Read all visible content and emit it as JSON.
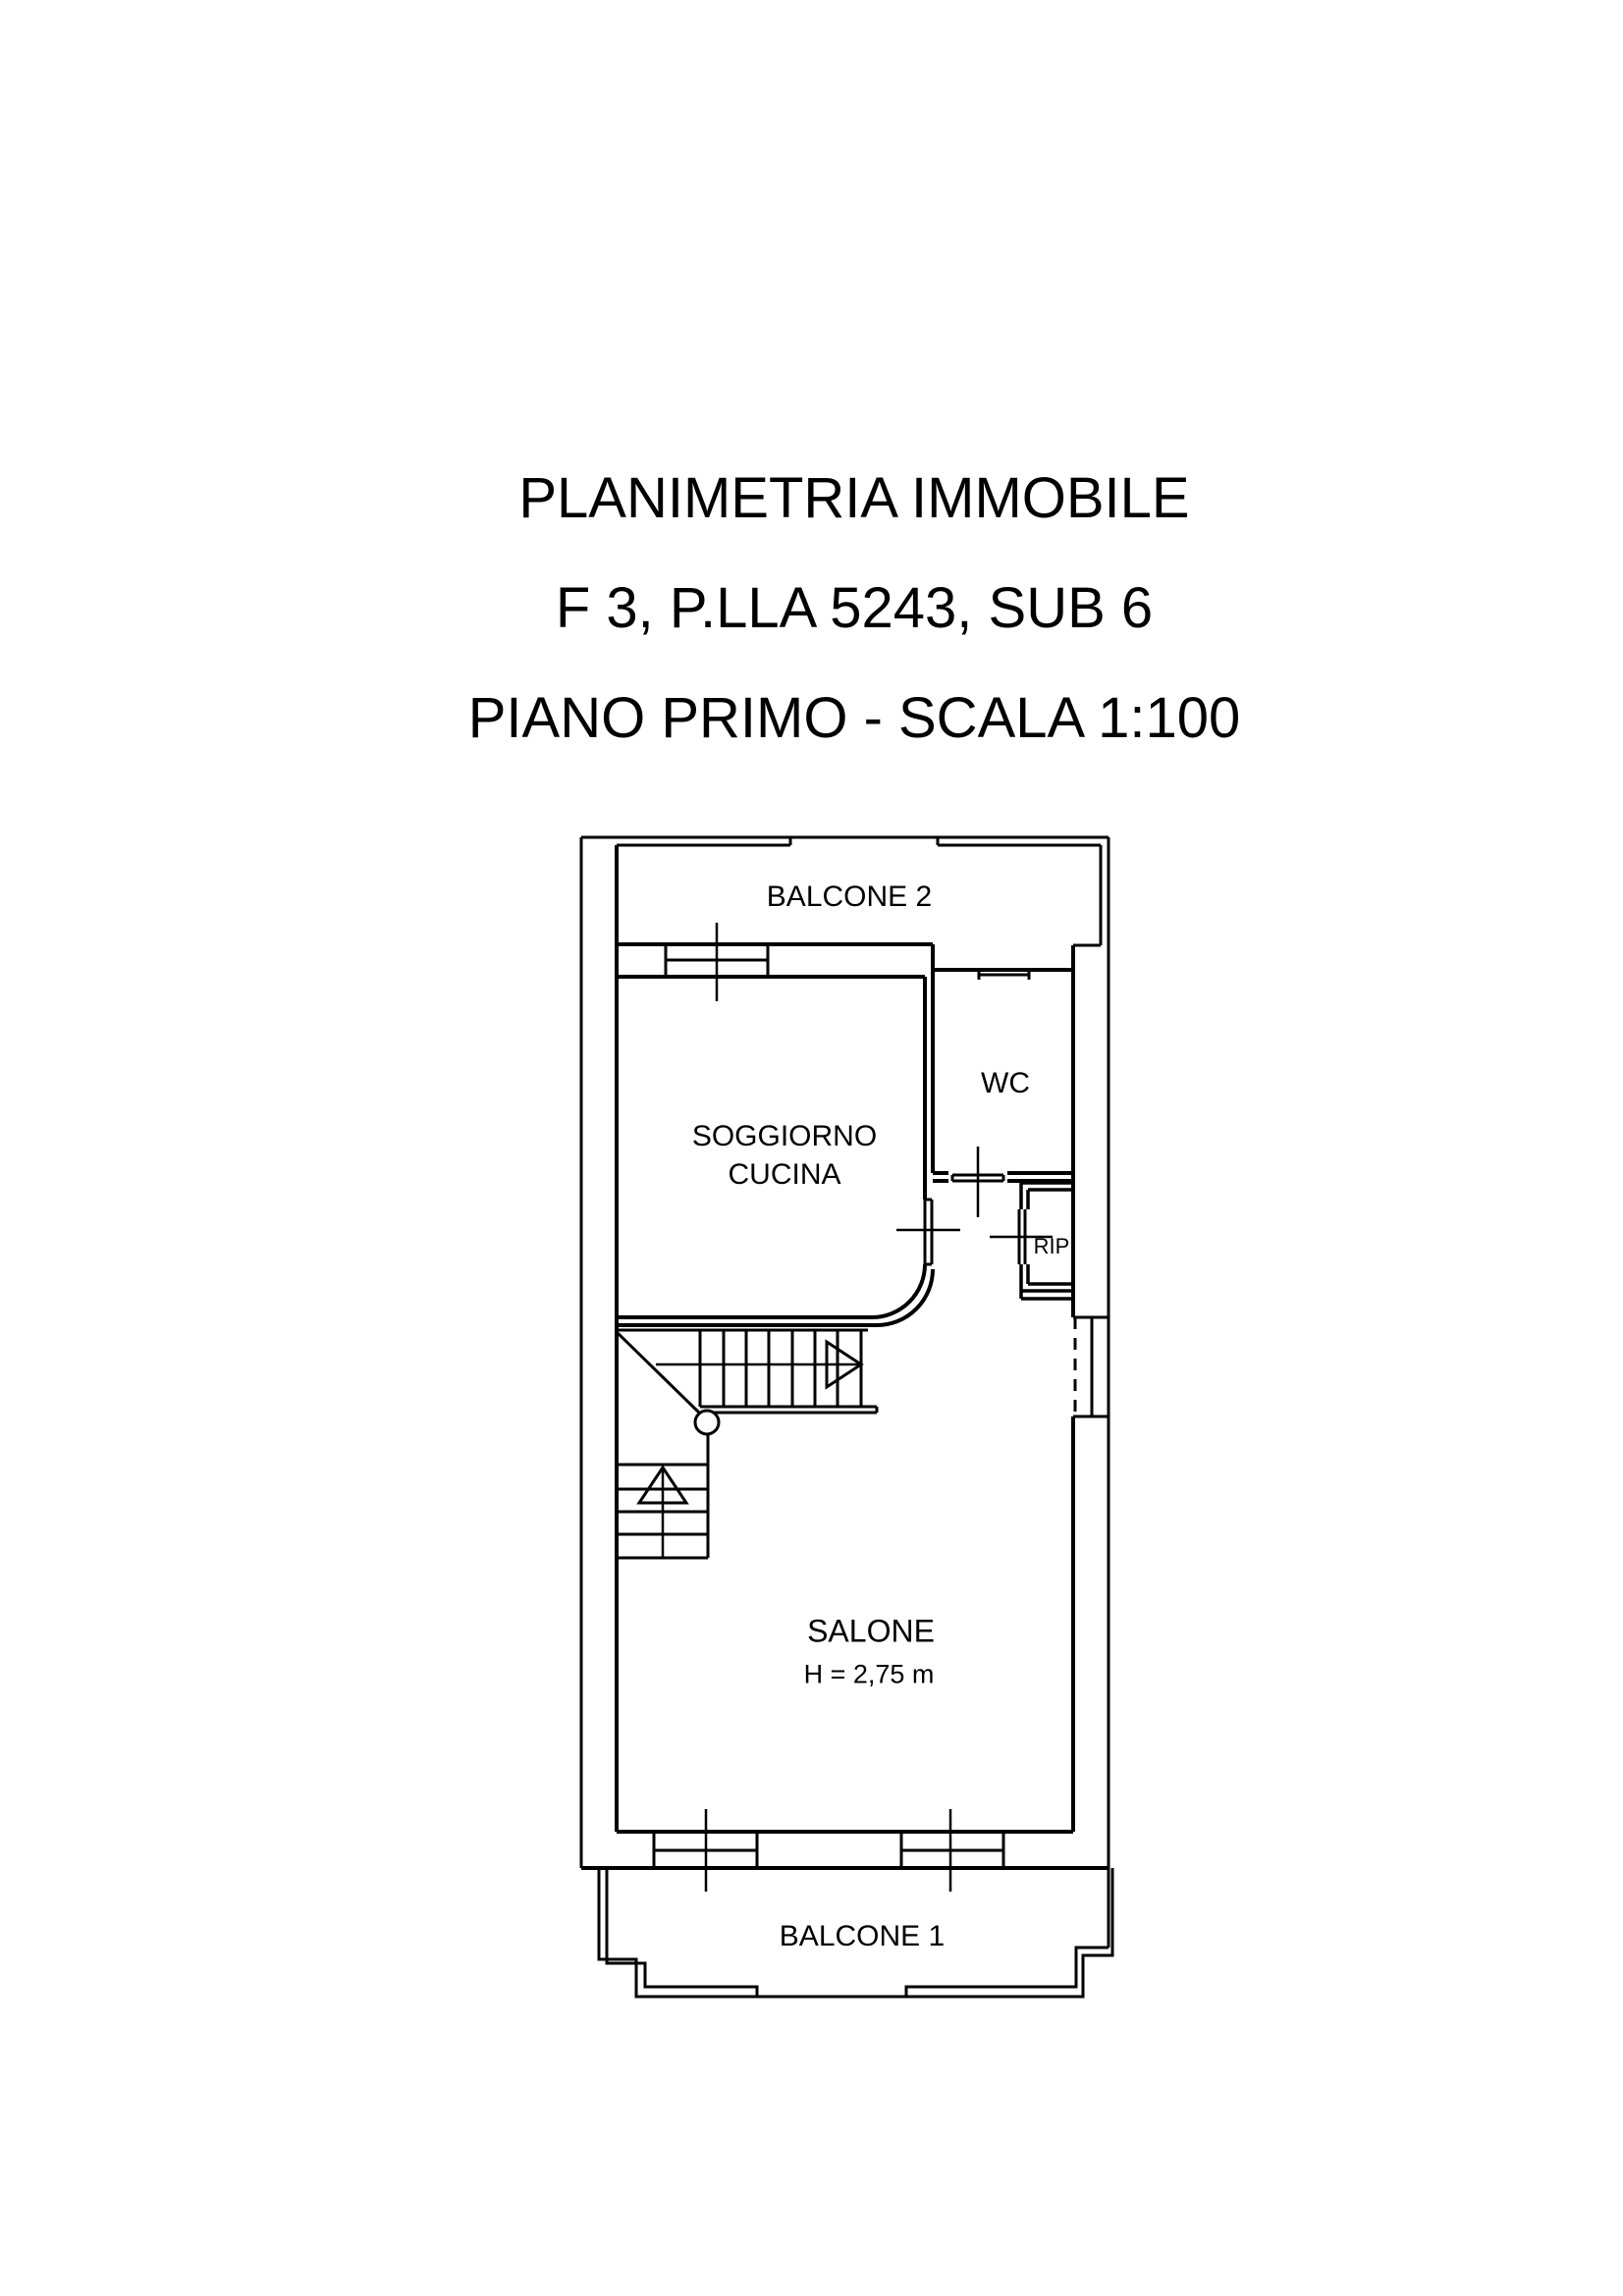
{
  "title": {
    "line1": "PLANIMETRIA IMMOBILE",
    "line2": "F 3, P.LLA 5243, SUB 6",
    "line3": "PIANO PRIMO - SCALA 1:100"
  },
  "rooms": {
    "balcone2": "BALCONE 2",
    "soggiorno_line1": "SOGGIORNO",
    "soggiorno_line2": "CUCINA",
    "wc": "WC",
    "rip": "RIP",
    "salone": "SALONE",
    "salone_height": "H = 2,75 m",
    "balcone1": "BALCONE 1"
  },
  "colors": {
    "line": "#000000",
    "background": "#ffffff",
    "text": "#000000"
  }
}
